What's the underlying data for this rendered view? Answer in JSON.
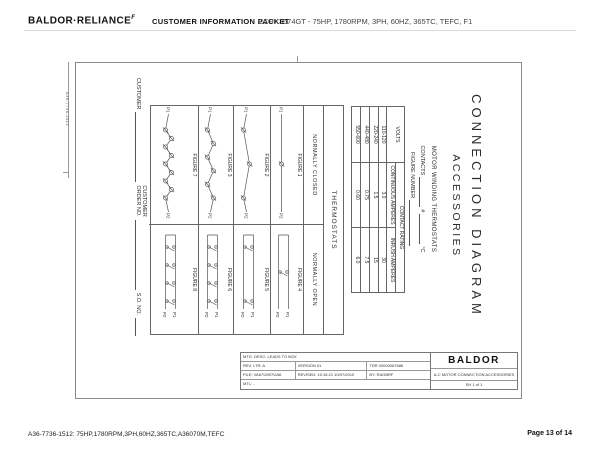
{
  "header": {
    "logo": "BALDOR·RELIANCE",
    "logo_mark": "F",
    "title": "CUSTOMER INFORMATION PACKET",
    "spec": "CCPX3674GT - 75HP, 1780RPM, 3PH, 60HZ, 365TC, TEFC, F1"
  },
  "footer": {
    "left": "A36-7736-1512: 75HP,1780RPM,3PH,60HZ,365TC,A36070M,TEFC",
    "right": "Page 13 of 14"
  },
  "drawing": {
    "edge_code": "A36-7736-1512",
    "title_line1": "CONNECTION  DIAGRAM",
    "title_line2": "ACCESSORIES",
    "thermostat_header": "MOTOR WINDING THERMOSTATS",
    "contacts_label": "CONTACTS",
    "contacts_hash": "#",
    "contacts_unit": "°C",
    "figure_number_label": "FIGURE NUMBER",
    "rating_table": {
      "volts_header": "VOLTS",
      "rating_header": "CONTACT RATING",
      "col_continuous": "CONTINUOUS AMPERES",
      "col_inrush": "INRUSH AMPERES",
      "rows": [
        {
          "volts": "110-120",
          "continuous": "3.0",
          "inrush": "30"
        },
        {
          "volts": "220-240",
          "continuous": "1.5",
          "inrush": "15"
        },
        {
          "volts": "440-480",
          "continuous": "0.75",
          "inrush": "7.5"
        },
        {
          "volts": "550-600",
          "continuous": "0.60",
          "inrush": "6.0"
        }
      ]
    },
    "figure_box": {
      "header": "THERMOSTATS",
      "left_header": "NORMALLY CLOSED",
      "right_header": "NORMALLY OPEN",
      "terminal_p1": "P1",
      "terminal_p2": "P2",
      "rows": [
        {
          "closed": {
            "label": "FIGURE 1",
            "contacts": 1
          },
          "open": {
            "label": "FIGURE 4",
            "contacts": 1
          }
        },
        {
          "closed": {
            "label": "FIGURE 2",
            "contacts": 3
          },
          "open": {
            "label": "FIGURE 5",
            "contacts": 2
          }
        },
        {
          "closed": {
            "label": "FIGURE 3",
            "contacts": 6
          },
          "open": {
            "label": "FIGURE 6",
            "contacts": 4
          }
        },
        {
          "closed": {
            "label": "FIGURE 7",
            "contacts": 9
          },
          "open": {
            "label": "FIGURE 8",
            "contacts": 4
          }
        }
      ]
    },
    "customer_fields": {
      "customer": "CUSTOMER",
      "order_line1": "CUSTOMER",
      "order_line2": "ORDER NO.",
      "so": "S.O. NO."
    },
    "title_block": {
      "mtg_desc": "MTG. DESC: LEADS TO BOX",
      "rev_ltr": "REV. LTR: A",
      "version": "VERSION 01",
      "tdr": "TDR 00000087686",
      "file": "FILE: VA67\\2697\\2A6",
      "revised": "REVISED: 10:16:21 10/07/2010",
      "by": "BY: RAGBRF",
      "mtl": "MTL: -",
      "logo": "BALDOR",
      "drawing_title": "A-C MOTOR CONNECTION ACCESSORIES",
      "sheet": "SH 1 of 1"
    }
  }
}
